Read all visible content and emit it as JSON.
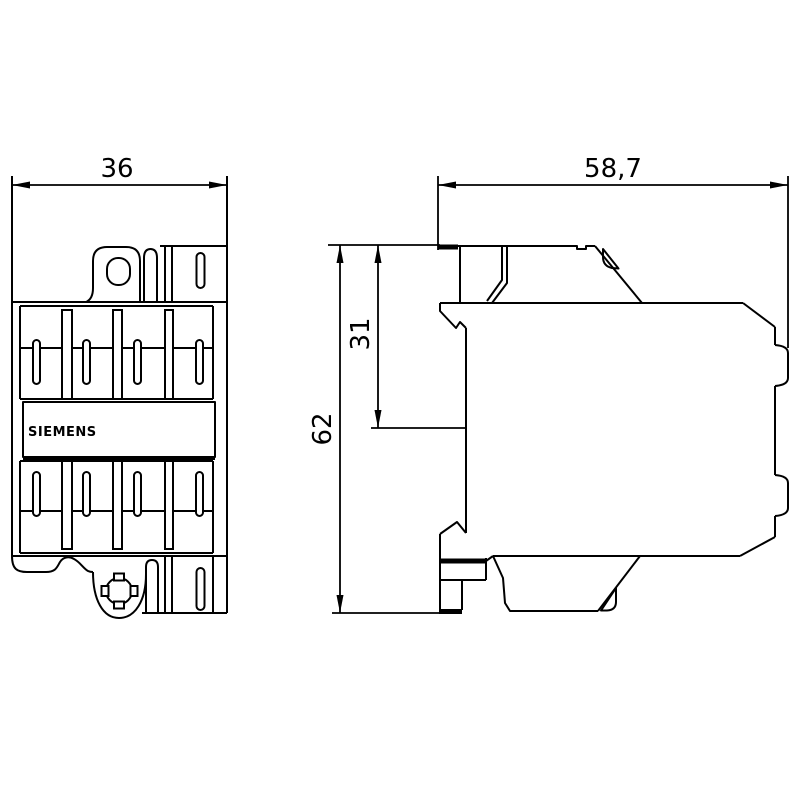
{
  "drawing": {
    "background": "#ffffff",
    "line_color": "#000000",
    "front_view": {
      "brand_label": "SIEMENS",
      "width_dimension": "36"
    },
    "side_view": {
      "depth_dimension": "58,7",
      "overall_height_dimension": "62",
      "upper_height_dimension": "31"
    }
  }
}
